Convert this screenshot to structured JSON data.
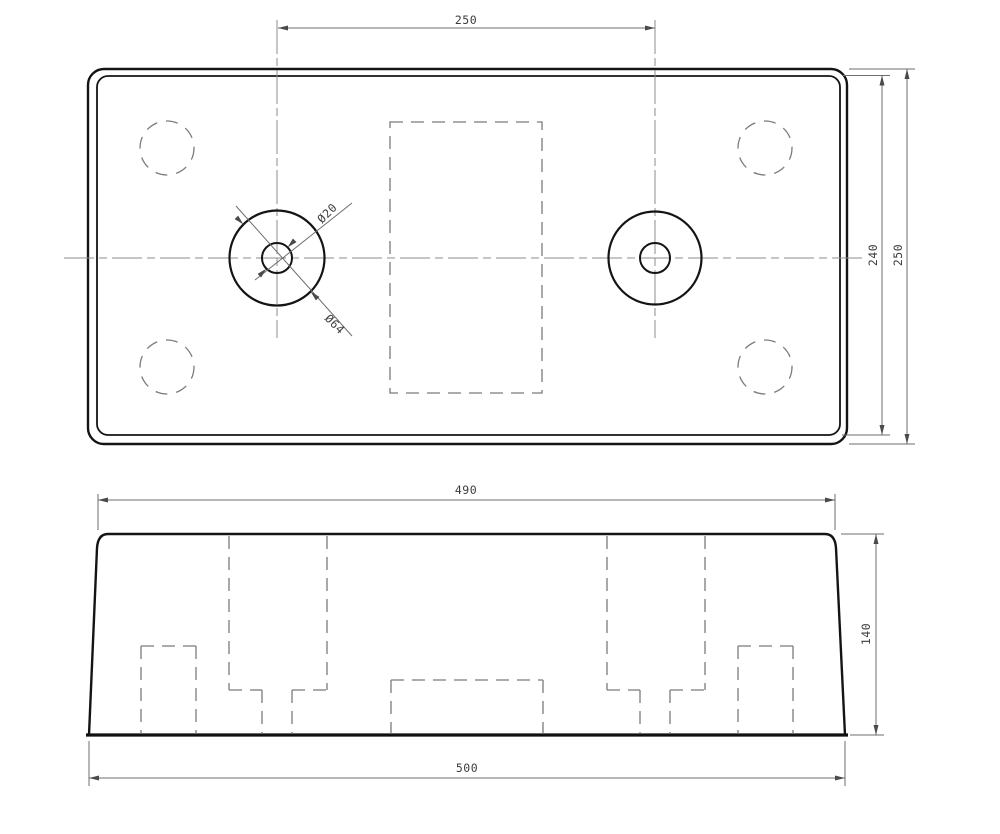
{
  "drawing": {
    "kind": "technical drawing, two orthographic views (plan view with two counterbored holes, front elevation with hidden pockets)",
    "background": "#ffffff",
    "colors": {
      "outline": "#141414",
      "hidden_lines": "#7b7b7b",
      "dimension_lines": "#6e6e6e",
      "text": "#3c3c3c"
    }
  },
  "labels": {
    "top_view": {
      "hole_center_distance": "250",
      "inner_outline_height": "240",
      "overall_height": "250",
      "hole_bore_diameter": "Ø20",
      "hole_boss_diameter": "Ø64"
    },
    "front_view": {
      "top_width": "490",
      "height": "140",
      "overall_width": "500"
    }
  }
}
